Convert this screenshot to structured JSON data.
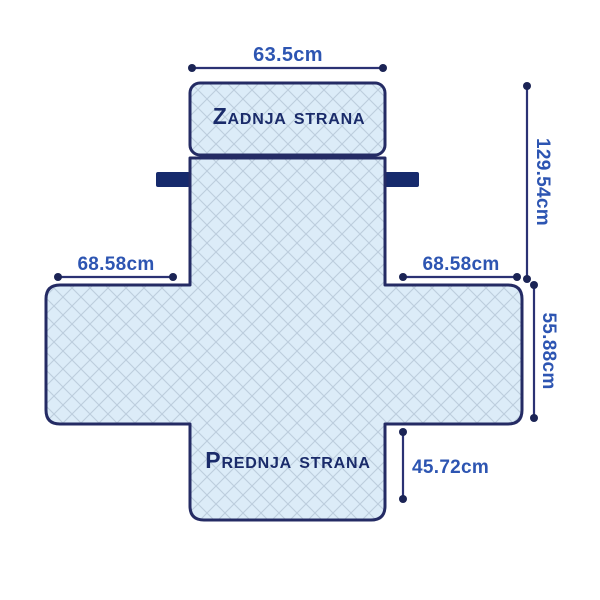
{
  "diagram": {
    "description": "Sofa cover dimension diagram, cross-shaped quilted cover",
    "panels": {
      "back_label": "Zadnja strana",
      "front_label": "Prednja strana"
    },
    "dimensions": {
      "back_width": "63.5cm",
      "total_length": "129.54cm",
      "left_arm_width": "68.58cm",
      "right_arm_width": "68.58cm",
      "seat_side_depth": "55.88cm",
      "front_drop": "45.72cm"
    },
    "colors": {
      "background": "#ffffff",
      "fabric_fill": "#dcecf8",
      "quilt_line": "#bccddd",
      "outline": "#242b64",
      "strap": "#162a6c",
      "dimension_line": "#2b3274",
      "dimension_dot": "#1b2455",
      "dimension_text": "#2d55b2",
      "panel_label_text": "#1a2b6a"
    }
  }
}
